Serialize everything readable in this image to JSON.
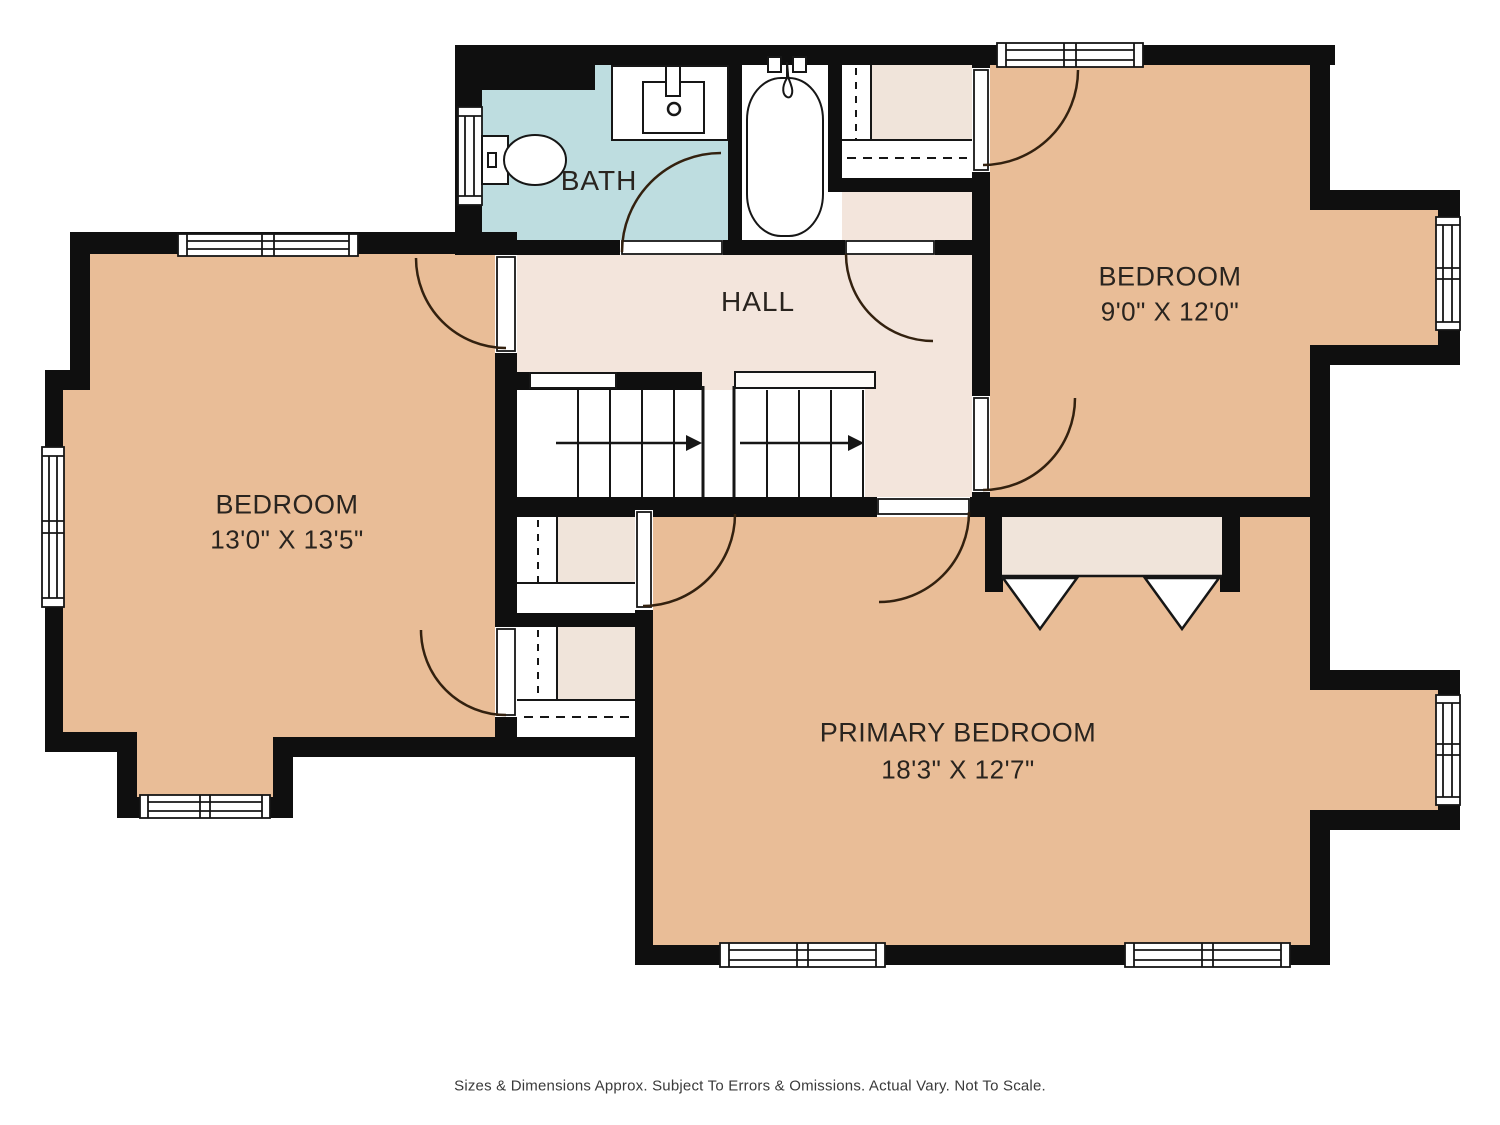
{
  "plan": {
    "type": "floor-plan",
    "floor": "upper level",
    "rooms": [
      {
        "id": "bath",
        "label": "BATH",
        "dims": "",
        "floor_color": "#bedde0",
        "fixtures": [
          "toilet",
          "sink-vanity",
          "bathtub"
        ],
        "window_count": 1,
        "door_count": 1
      },
      {
        "id": "hall",
        "label": "HALL",
        "dims": "",
        "floor_color": "#f3e5dc",
        "features": [
          "staircase-double-flight",
          "hall-closet"
        ],
        "door_count": 0
      },
      {
        "id": "bedroom-right",
        "label": "BEDROOM",
        "dims": "9'0\" X 12'0\"",
        "floor_color": "#e9bd97",
        "features": [
          "closet",
          "window-bay"
        ],
        "window_count": 2,
        "door_count": 2
      },
      {
        "id": "bedroom-left",
        "label": "BEDROOM",
        "dims": "13'0\" X 13'5\"",
        "floor_color": "#e9bd97",
        "features": [
          "closet",
          "window-bay"
        ],
        "window_count": 3,
        "door_count": 2
      },
      {
        "id": "primary-bedroom",
        "label": "PRIMARY BEDROOM",
        "dims": "18'3\" X 12'7\"",
        "floor_color": "#e9bd97",
        "features": [
          "bifold-closet",
          "walk-in-closet",
          "window-bay"
        ],
        "window_count": 3,
        "door_count": 2
      }
    ],
    "stairs": {
      "direction_arrows": 2,
      "flights": 2
    },
    "colors": {
      "wall": "#0f0f0f",
      "room_tan": "#e9bd97",
      "bath_teal": "#bedde0",
      "hall_beige": "#f3e5dc",
      "closet_beige": "#f0e4da",
      "line": "#161616",
      "door_arc": "#33210f",
      "text": "#29241f"
    }
  },
  "footer": {
    "disclaimer": "Sizes & Dimensions Approx. Subject To Errors & Omissions. Actual Vary. Not To Scale."
  }
}
